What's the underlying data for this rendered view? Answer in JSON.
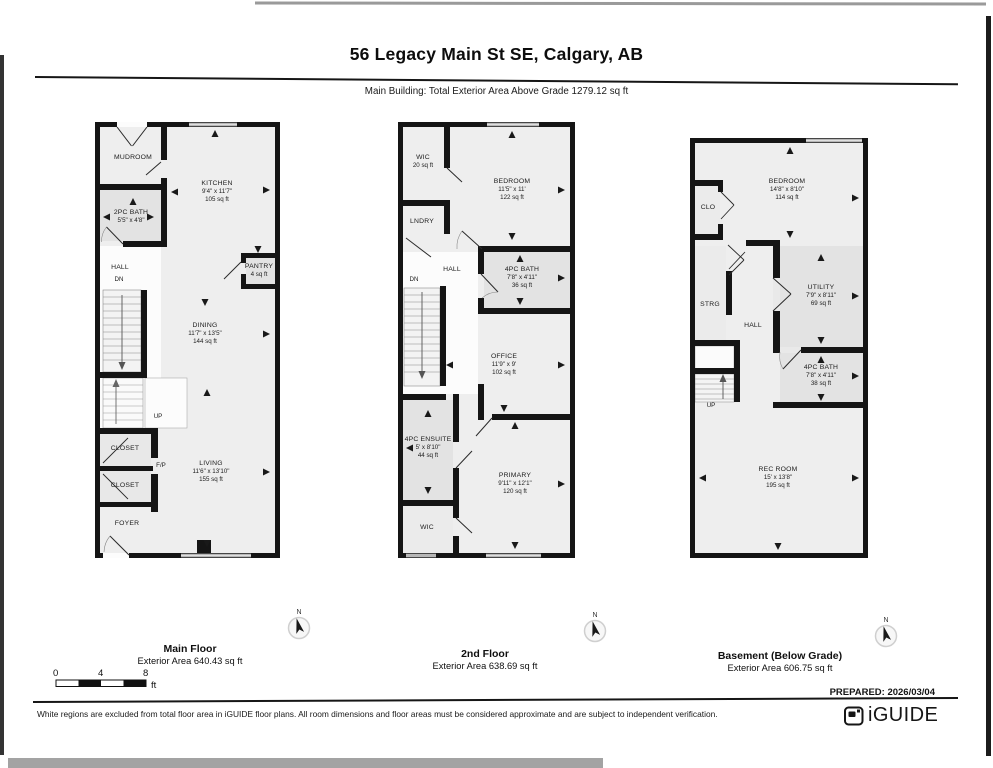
{
  "page": {
    "title": "56 Legacy Main St SE, Calgary, AB",
    "subtitle": "Main Building: Total Exterior Area Above Grade 1279.12 sq ft",
    "prepared": "PREPARED: 2026/03/04",
    "disclaimer": "White regions are excluded from total floor area in iGUIDE floor plans. All room dimensions and floor areas must be considered approximate and are subject to independent verification.",
    "brand": "iGUIDE",
    "compass_n": "N",
    "scale": {
      "t0": "0",
      "t1": "4",
      "t2": "8",
      "unit": "ft"
    }
  },
  "floors": [
    {
      "name": "Main Floor",
      "area_label": "Exterior Area 640.43 sq ft",
      "rooms": [
        {
          "name": "MUDROOM"
        },
        {
          "name": "KITCHEN",
          "dims": "9'4\" x 11'7\"",
          "area": "105 sq ft"
        },
        {
          "name": "2PC BATH",
          "dims": "5'5\" x 4'8\""
        },
        {
          "name": "HALL"
        },
        {
          "name": "DN"
        },
        {
          "name": "PANTRY",
          "area": "4 sq ft"
        },
        {
          "name": "DINING",
          "dims": "11'7\" x 13'5\"",
          "area": "144 sq ft"
        },
        {
          "name": "UP"
        },
        {
          "name": "CLOSET"
        },
        {
          "name": "F/P"
        },
        {
          "name": "CLOSET"
        },
        {
          "name": "LIVING",
          "dims": "11'6\" x 13'10\"",
          "area": "155 sq ft"
        },
        {
          "name": "FOYER"
        }
      ]
    },
    {
      "name": "2nd Floor",
      "area_label": "Exterior Area 638.69 sq ft",
      "rooms": [
        {
          "name": "WIC",
          "area": "20 sq ft"
        },
        {
          "name": "BEDROOM",
          "dims": "11'5\" x 11'",
          "area": "122 sq ft"
        },
        {
          "name": "LNDRY"
        },
        {
          "name": "HALL"
        },
        {
          "name": "DN"
        },
        {
          "name": "4PC BATH",
          "dims": "7'8\" x 4'11\"",
          "area": "36 sq ft"
        },
        {
          "name": "OFFICE",
          "dims": "11'9\" x 9'",
          "area": "102 sq ft"
        },
        {
          "name": "4PC ENSUITE",
          "dims": "5' x 8'10\"",
          "area": "44 sq ft"
        },
        {
          "name": "PRIMARY",
          "dims": "9'11\" x 12'1\"",
          "area": "120 sq ft"
        },
        {
          "name": "WIC"
        }
      ]
    },
    {
      "name": "Basement (Below Grade)",
      "area_label": "Exterior Area 606.75 sq ft",
      "rooms": [
        {
          "name": "BEDROOM",
          "dims": "14'8\" x 8'10\"",
          "area": "114 sq ft"
        },
        {
          "name": "CLO"
        },
        {
          "name": "STRG"
        },
        {
          "name": "HALL"
        },
        {
          "name": "UTILITY",
          "dims": "7'9\" x 8'11\"",
          "area": "69 sq ft"
        },
        {
          "name": "4PC BATH",
          "dims": "7'8\" x 4'11\"",
          "area": "38 sq ft"
        },
        {
          "name": "UP"
        },
        {
          "name": "REC ROOM",
          "dims": "15' x 13'8\"",
          "area": "195 sq ft"
        }
      ]
    }
  ]
}
